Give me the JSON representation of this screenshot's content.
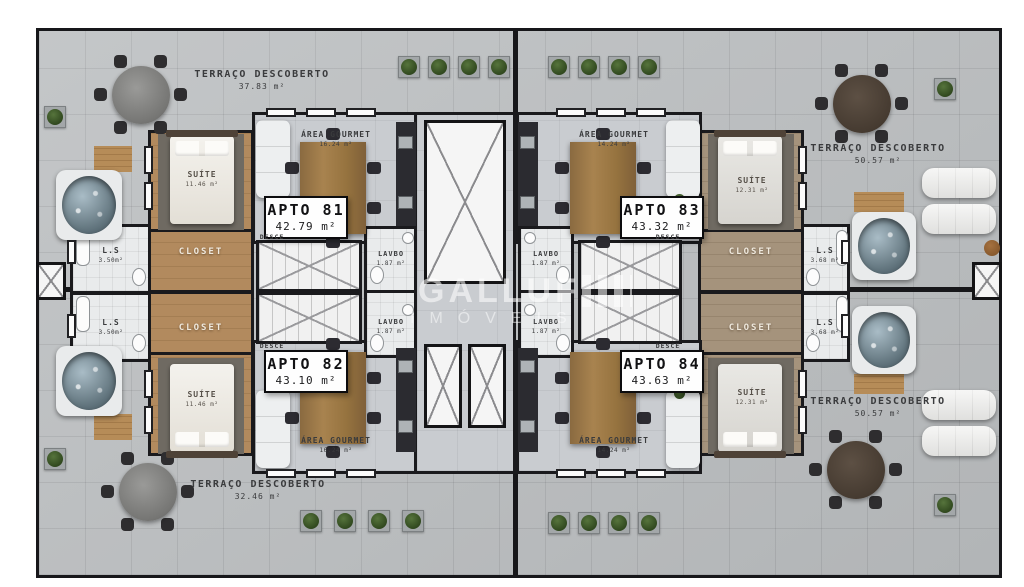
{
  "watermark": {
    "brand": "GALLUF",
    "subtitle": "IMÓVEIS"
  },
  "terraces": {
    "top_left": {
      "label": "TERRAÇO DESCOBERTO",
      "area": "37.83 m²"
    },
    "top_right": {
      "label": "TERRAÇO DESCOBERTO",
      "area": "50.57 m²"
    },
    "bottom_left": {
      "label": "TERRAÇO DESCOBERTO",
      "area": "32.46 m²"
    },
    "bottom_right": {
      "label": "TERRAÇO DESCOBERTO",
      "area": "50.57 m²"
    }
  },
  "apartments": {
    "apto81": {
      "name": "APTO 81",
      "area": "42.79 m²",
      "suite": "SUÍTE",
      "suite_area": "11.46 m²",
      "closet": "CLOSET",
      "gourmet": "ÁREA GOURMET",
      "gourmet_area": "16.24 m²",
      "lavbo": "LAVBO",
      "lavbo_area": "1.87 m²",
      "ls": "L.S",
      "ls_area": "3.50m²",
      "desce": "DESCE"
    },
    "apto82": {
      "name": "APTO 82",
      "area": "43.10 m²",
      "suite": "SUÍTE",
      "suite_area": "11.46 m²",
      "closet": "CLOSET",
      "gourmet": "ÁREA GOURMET",
      "gourmet_area": "16.24 m²",
      "lavbo": "LAVBO",
      "lavbo_area": "1.87 m²",
      "ls": "L.S",
      "ls_area": "3.50m²",
      "desce": "DESCE"
    },
    "apto83": {
      "name": "APTO 83",
      "area": "43.32 m²",
      "suite": "SUÍTE",
      "suite_area": "12.31 m²",
      "closet": "CLOSET",
      "gourmet": "ÁREA GOURMET",
      "gourmet_area": "14.24 m²",
      "lavbo": "LAVBO",
      "lavbo_area": "1.87 m²",
      "ls": "L.S",
      "ls_area": "3.68 m²",
      "desce": "DESCE"
    },
    "apto84": {
      "name": "APTO 84",
      "area": "43.63 m²",
      "suite": "SUÍTE",
      "suite_area": "12.31 m²",
      "closet": "CLOSET",
      "gourmet": "ÁREA GOURMET",
      "gourmet_area": "14.24 m²",
      "lavbo": "LAVBO",
      "lavbo_area": "1.87 m²",
      "ls": "L.S",
      "ls_area": "3.68 m²",
      "desce": "DESCE"
    }
  }
}
